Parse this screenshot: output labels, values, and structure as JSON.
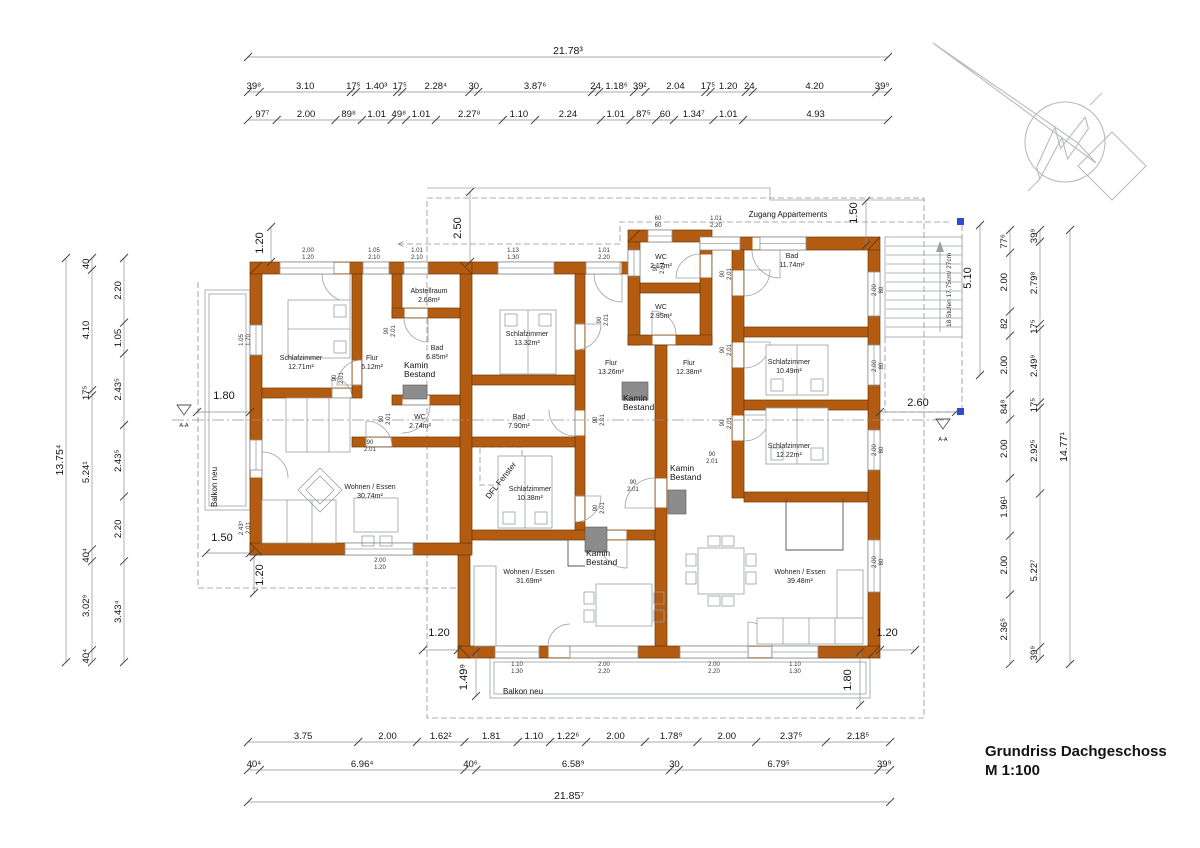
{
  "title": {
    "name": "Grundriss Dachgeschoss",
    "scale": "M 1:100"
  },
  "annotations": {
    "zugang": "Zugang Appartements",
    "balkon_left": "Balkon neu",
    "balkon_bottom": "Balkon neu",
    "stairs": "18 Stufen 17,75cm/ 27cm",
    "dfl_fenster": "DFL Fenster",
    "section_left": "A-A",
    "section_right": "A-A",
    "kamin_line1": "Kamin",
    "kamin_line2": "Bestand"
  },
  "rooms": [
    {
      "name": "Schlafzimmer",
      "area": "12.71m²",
      "x": 301,
      "y": 360
    },
    {
      "name": "Flur",
      "area": "6.12m²",
      "x": 372,
      "y": 360
    },
    {
      "name": "Abstellraum",
      "area": "2.68m²",
      "x": 429,
      "y": 293
    },
    {
      "name": "Bad",
      "area": "6.85m²",
      "x": 437,
      "y": 350
    },
    {
      "name": "WC",
      "area": "2.74m²",
      "x": 420,
      "y": 419
    },
    {
      "name": "Wohnen / Essen",
      "area": "30.74m²",
      "x": 370,
      "y": 489
    },
    {
      "name": "Schlafzimmer",
      "area": "13.32m²",
      "x": 527,
      "y": 336
    },
    {
      "name": "Bad",
      "area": "7.90m²",
      "x": 519,
      "y": 419
    },
    {
      "name": "Schlafzimmer",
      "area": "10.38m²",
      "x": 530,
      "y": 491
    },
    {
      "name": "Flur",
      "area": "13.26m²",
      "x": 611,
      "y": 365
    },
    {
      "name": "WC",
      "area": "2.17m²",
      "x": 661,
      "y": 259
    },
    {
      "name": "WC",
      "area": "2.95m²",
      "x": 661,
      "y": 309
    },
    {
      "name": "Wohnen / Essen",
      "area": "31.69m²",
      "x": 529,
      "y": 574
    },
    {
      "name": "Bad",
      "area": "11.74m²",
      "x": 792,
      "y": 258
    },
    {
      "name": "Flur",
      "area": "12.38m²",
      "x": 689,
      "y": 365
    },
    {
      "name": "Schlafzimmer",
      "area": "10.49m²",
      "x": 789,
      "y": 364
    },
    {
      "name": "Schlafzimmer",
      "area": "12.22m²",
      "x": 789,
      "y": 448
    },
    {
      "name": "Wohnen / Essen",
      "area": "39.48m²",
      "x": 800,
      "y": 574
    }
  ],
  "kamin_positions": [
    {
      "x": 404,
      "y": 368
    },
    {
      "x": 623,
      "y": 401
    },
    {
      "x": 670,
      "y": 471
    },
    {
      "x": 586,
      "y": 556
    }
  ],
  "dimensions": {
    "px_per_m": 29.38,
    "top_total": {
      "dir": "h",
      "x0": 248,
      "y": 57,
      "labels": [
        "21.78³"
      ],
      "values": [
        21.783
      ],
      "big": true
    },
    "top_row1": {
      "dir": "h",
      "x0": 248,
      "y": 92,
      "labels": [
        "39⁸",
        "3.10",
        "17⁵",
        "1.40³",
        "17⁵",
        "2.28⁴",
        "30",
        "3.87⁶",
        "24",
        "1.18⁶",
        "39²",
        "2.04",
        "17⁵",
        "1.20",
        "24",
        "4.20",
        "39⁹"
      ],
      "values": [
        0.398,
        3.1,
        0.175,
        1.403,
        0.175,
        2.284,
        0.3,
        3.876,
        0.24,
        1.186,
        0.392,
        2.04,
        0.175,
        1.2,
        0.24,
        4.2,
        0.399
      ]
    },
    "top_row2": {
      "dir": "h",
      "x0": 248,
      "y": 120,
      "labels": [
        "97⁷",
        "2.00",
        "89⁸",
        "1.01",
        "49⁸",
        "1.01",
        "2.27⁸",
        "1.10",
        "2.24",
        "1.01",
        "87⁵",
        "60",
        "1.34⁷",
        "1.01",
        "4.93"
      ],
      "values": [
        0.977,
        2.0,
        0.898,
        1.01,
        0.498,
        1.01,
        2.278,
        1.1,
        2.24,
        1.01,
        0.875,
        0.6,
        1.347,
        1.01,
        4.93
      ]
    },
    "bottom_row1": {
      "dir": "h",
      "x0": 248,
      "y": 742,
      "labels": [
        "3.75",
        "2.00",
        "1.62²",
        "1.81",
        "1.10",
        "1.22⁶",
        "2.00",
        "1.78⁹",
        "2.00",
        "2.37⁵",
        "2.18⁵"
      ],
      "values": [
        3.75,
        2.0,
        1.622,
        1.81,
        1.1,
        1.226,
        2.0,
        1.789,
        2.0,
        2.375,
        2.185
      ]
    },
    "bottom_row2": {
      "dir": "h",
      "x0": 248,
      "y": 770,
      "labels": [
        "40⁴",
        "6.96⁴",
        "40⁶",
        "6.58⁹",
        "30",
        "6.79⁵",
        "39⁹"
      ],
      "values": [
        0.404,
        6.964,
        0.406,
        6.589,
        0.3,
        6.795,
        0.399
      ]
    },
    "bottom_total": {
      "dir": "h",
      "x0": 248,
      "y": 802,
      "labels": [
        "21.85⁷"
      ],
      "values": [
        21.857
      ],
      "big": true
    },
    "left_total": {
      "dir": "v",
      "y0": 258,
      "x": 66,
      "labels": [
        "13.75⁴"
      ],
      "values": [
        13.754
      ],
      "big": true
    },
    "left_outer": {
      "dir": "v",
      "y0": 258,
      "x": 92,
      "labels": [
        "40",
        "4.10",
        "17⁵",
        "5.24¹",
        "40⁴",
        "3.02⁹",
        "40⁴"
      ],
      "values": [
        0.4,
        4.1,
        0.175,
        5.241,
        0.404,
        3.029,
        0.404
      ]
    },
    "left_inner": {
      "dir": "v",
      "y0": 258,
      "x": 124,
      "labels": [
        "2.20",
        "1.05",
        "2.43⁵",
        "2.43⁵",
        "2.20",
        "3.43⁴"
      ],
      "values": [
        2.2,
        1.05,
        2.435,
        2.435,
        2.2,
        3.434
      ]
    },
    "right_inner": {
      "dir": "v",
      "y0": 230,
      "x": 1010,
      "labels": [
        "77⁶",
        "2.00",
        "82",
        "2.00",
        "84⁸",
        "2.00",
        "1.96¹",
        "2.00",
        "2.36⁵"
      ],
      "values": [
        0.776,
        2.0,
        0.82,
        2.0,
        0.848,
        2.0,
        1.961,
        2.0,
        2.365
      ]
    },
    "right_mid": {
      "dir": "v",
      "y0": 230,
      "x": 1040,
      "labels": [
        "39⁹",
        "2.79⁸",
        "17⁵",
        "2.49⁹",
        "17⁵",
        "2.92⁵",
        "5.22⁷",
        "39⁹"
      ],
      "values": [
        0.399,
        2.798,
        0.175,
        2.499,
        0.175,
        2.925,
        5.227,
        0.399
      ]
    },
    "right_total": {
      "dir": "v",
      "y0": 230,
      "x": 1070,
      "labels": [
        "14.77¹"
      ],
      "values": [
        14.771
      ],
      "big": true
    }
  },
  "local_dims": [
    {
      "t": "2.50",
      "x": 461,
      "y": 228,
      "rot": -90,
      "line": [
        470,
        192,
        470,
        262
      ]
    },
    {
      "t": "1.50",
      "x": 857,
      "y": 213,
      "rot": -90,
      "line": [
        866,
        201,
        866,
        245
      ]
    },
    {
      "t": "5.10",
      "x": 971,
      "y": 278,
      "rot": -90,
      "line": [
        980,
        225,
        980,
        375
      ]
    },
    {
      "t": "2.60",
      "x": 918,
      "y": 406,
      "rot": 0,
      "line": [
        880,
        412,
        956,
        412
      ]
    },
    {
      "t": "1.80",
      "x": 224,
      "y": 399,
      "rot": 0,
      "line": [
        197,
        412,
        250,
        412
      ]
    },
    {
      "t": "1.50",
      "x": 222,
      "y": 541,
      "rot": 0,
      "line": [
        206,
        553,
        250,
        553
      ]
    },
    {
      "t": "1.20",
      "x": 263,
      "y": 243,
      "rot": -90,
      "line": [
        271,
        227,
        271,
        262
      ]
    },
    {
      "t": "1.20",
      "x": 439,
      "y": 636,
      "rot": 0,
      "line": [
        423,
        650,
        458,
        650
      ]
    },
    {
      "t": "1.20",
      "x": 887,
      "y": 636,
      "rot": 0,
      "line": [
        880,
        650,
        915,
        650
      ]
    },
    {
      "t": "1.49⁹",
      "x": 467,
      "y": 677,
      "rot": -90,
      "line": [
        476,
        652,
        476,
        696
      ]
    },
    {
      "t": "1.80",
      "x": 851,
      "y": 680,
      "rot": -90,
      "line": [
        860,
        652,
        860,
        705
      ]
    },
    {
      "t": "1.20",
      "x": 263,
      "y": 575,
      "rot": -90,
      "line": [
        254,
        557,
        254,
        593
      ]
    }
  ],
  "window_labels": [
    {
      "t1": "2.00",
      "t2": "1.20",
      "x": 308,
      "y": 252,
      "rot": 0
    },
    {
      "t1": "1.05",
      "t2": "2.10",
      "x": 374,
      "y": 252,
      "rot": 0
    },
    {
      "t1": "1.01",
      "t2": "2.10",
      "x": 417,
      "y": 252,
      "rot": 0
    },
    {
      "t1": "1.13",
      "t2": "1.30",
      "x": 513,
      "y": 252,
      "rot": 0
    },
    {
      "t1": "1.01",
      "t2": "2.20",
      "x": 604,
      "y": 252,
      "rot": 0
    },
    {
      "t1": "60",
      "t2": "60",
      "x": 658,
      "y": 220,
      "rot": 0
    },
    {
      "t1": "1.01",
      "t2": "2.20",
      "x": 716,
      "y": 220,
      "rot": 0
    },
    {
      "t1": "2.00",
      "t2": "1.20",
      "x": 380,
      "y": 562,
      "rot": 0
    },
    {
      "t1": "1.10",
      "t2": "1.30",
      "x": 517,
      "y": 666,
      "rot": 0
    },
    {
      "t1": "2.00",
      "t2": "2.20",
      "x": 604,
      "y": 666,
      "rot": 0
    },
    {
      "t1": "2.00",
      "t2": "2.20",
      "x": 714,
      "y": 666,
      "rot": 0
    },
    {
      "t1": "1.10",
      "t2": "1.30",
      "x": 795,
      "y": 666,
      "rot": 0
    },
    {
      "t1": "1.05",
      "t2": "1.70",
      "x": 243,
      "y": 340,
      "rot": -90
    },
    {
      "t1": "2.43⁵",
      "t2": "2.01",
      "x": 243,
      "y": 528,
      "rot": -90
    },
    {
      "t1": "2.00",
      "t2": "80",
      "x": 876,
      "y": 290,
      "rot": -90
    },
    {
      "t1": "2.00",
      "t2": "80",
      "x": 876,
      "y": 366,
      "rot": -90
    },
    {
      "t1": "2.00",
      "t2": "80",
      "x": 876,
      "y": 450,
      "rot": -90
    },
    {
      "t1": "2.00",
      "t2": "80",
      "x": 876,
      "y": 562,
      "rot": -90
    }
  ],
  "door_labels": [
    {
      "t1": "90",
      "t2": "2.01",
      "x": 388,
      "y": 331,
      "rot": -90
    },
    {
      "t1": "90",
      "t2": "2.01",
      "x": 336,
      "y": 378,
      "rot": -90
    },
    {
      "t1": "90",
      "t2": "2.01",
      "x": 383,
      "y": 419,
      "rot": -90
    },
    {
      "t1": "90",
      "t2": "2.01",
      "x": 370,
      "y": 444,
      "rot": 0
    },
    {
      "t1": "90",
      "t2": "2.01",
      "x": 601,
      "y": 320,
      "rot": -90
    },
    {
      "t1": "90",
      "t2": "2.01",
      "x": 597,
      "y": 420,
      "rot": -90
    },
    {
      "t1": "90",
      "t2": "2.01",
      "x": 597,
      "y": 508,
      "rot": -90
    },
    {
      "t1": "90",
      "t2": "2.01",
      "x": 633,
      "y": 484,
      "rot": 0
    },
    {
      "t1": "90",
      "t2": "2.01",
      "x": 657,
      "y": 268,
      "rot": -90
    },
    {
      "t1": "90",
      "t2": "2.01",
      "x": 724,
      "y": 274,
      "rot": -90
    },
    {
      "t1": "90",
      "t2": "2.01",
      "x": 724,
      "y": 350,
      "rot": -90
    },
    {
      "t1": "90",
      "t2": "2.01",
      "x": 724,
      "y": 423,
      "rot": -90
    },
    {
      "t1": "90",
      "t2": "2.01",
      "x": 712,
      "y": 456,
      "rot": 0
    }
  ],
  "colors": {
    "wall": "#b25b11",
    "wall_stroke": "#6e3a06",
    "kamin": "#8c8c8c",
    "line": "#9aa0a4",
    "dash": "#8d9296",
    "text": "#141414",
    "blue_marker": "#2f4bd6"
  }
}
